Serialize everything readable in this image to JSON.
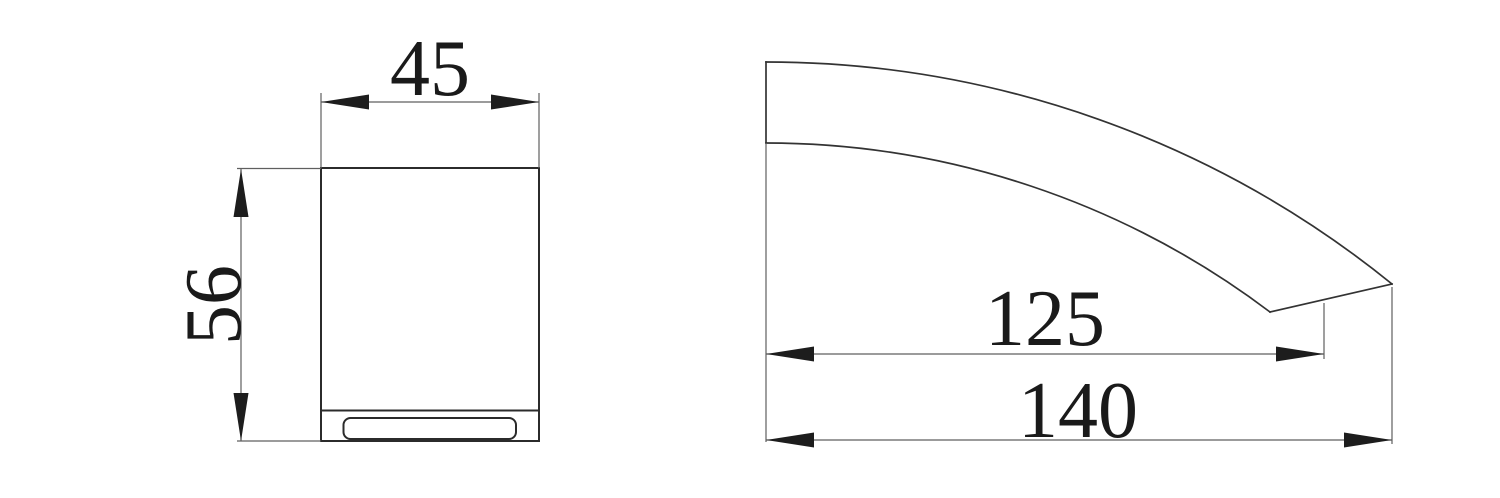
{
  "drawing": {
    "front_view": {
      "width_label": "45",
      "height_label": "56"
    },
    "side_view": {
      "spout_reach_label": "125",
      "overall_reach_label": "140"
    },
    "colors": {
      "background": "#ffffff",
      "object_line": "#2b2b2b",
      "dimension_line": "#5f5f5f",
      "arrow": "#1d1d1d",
      "text": "#1a1a1a"
    }
  }
}
